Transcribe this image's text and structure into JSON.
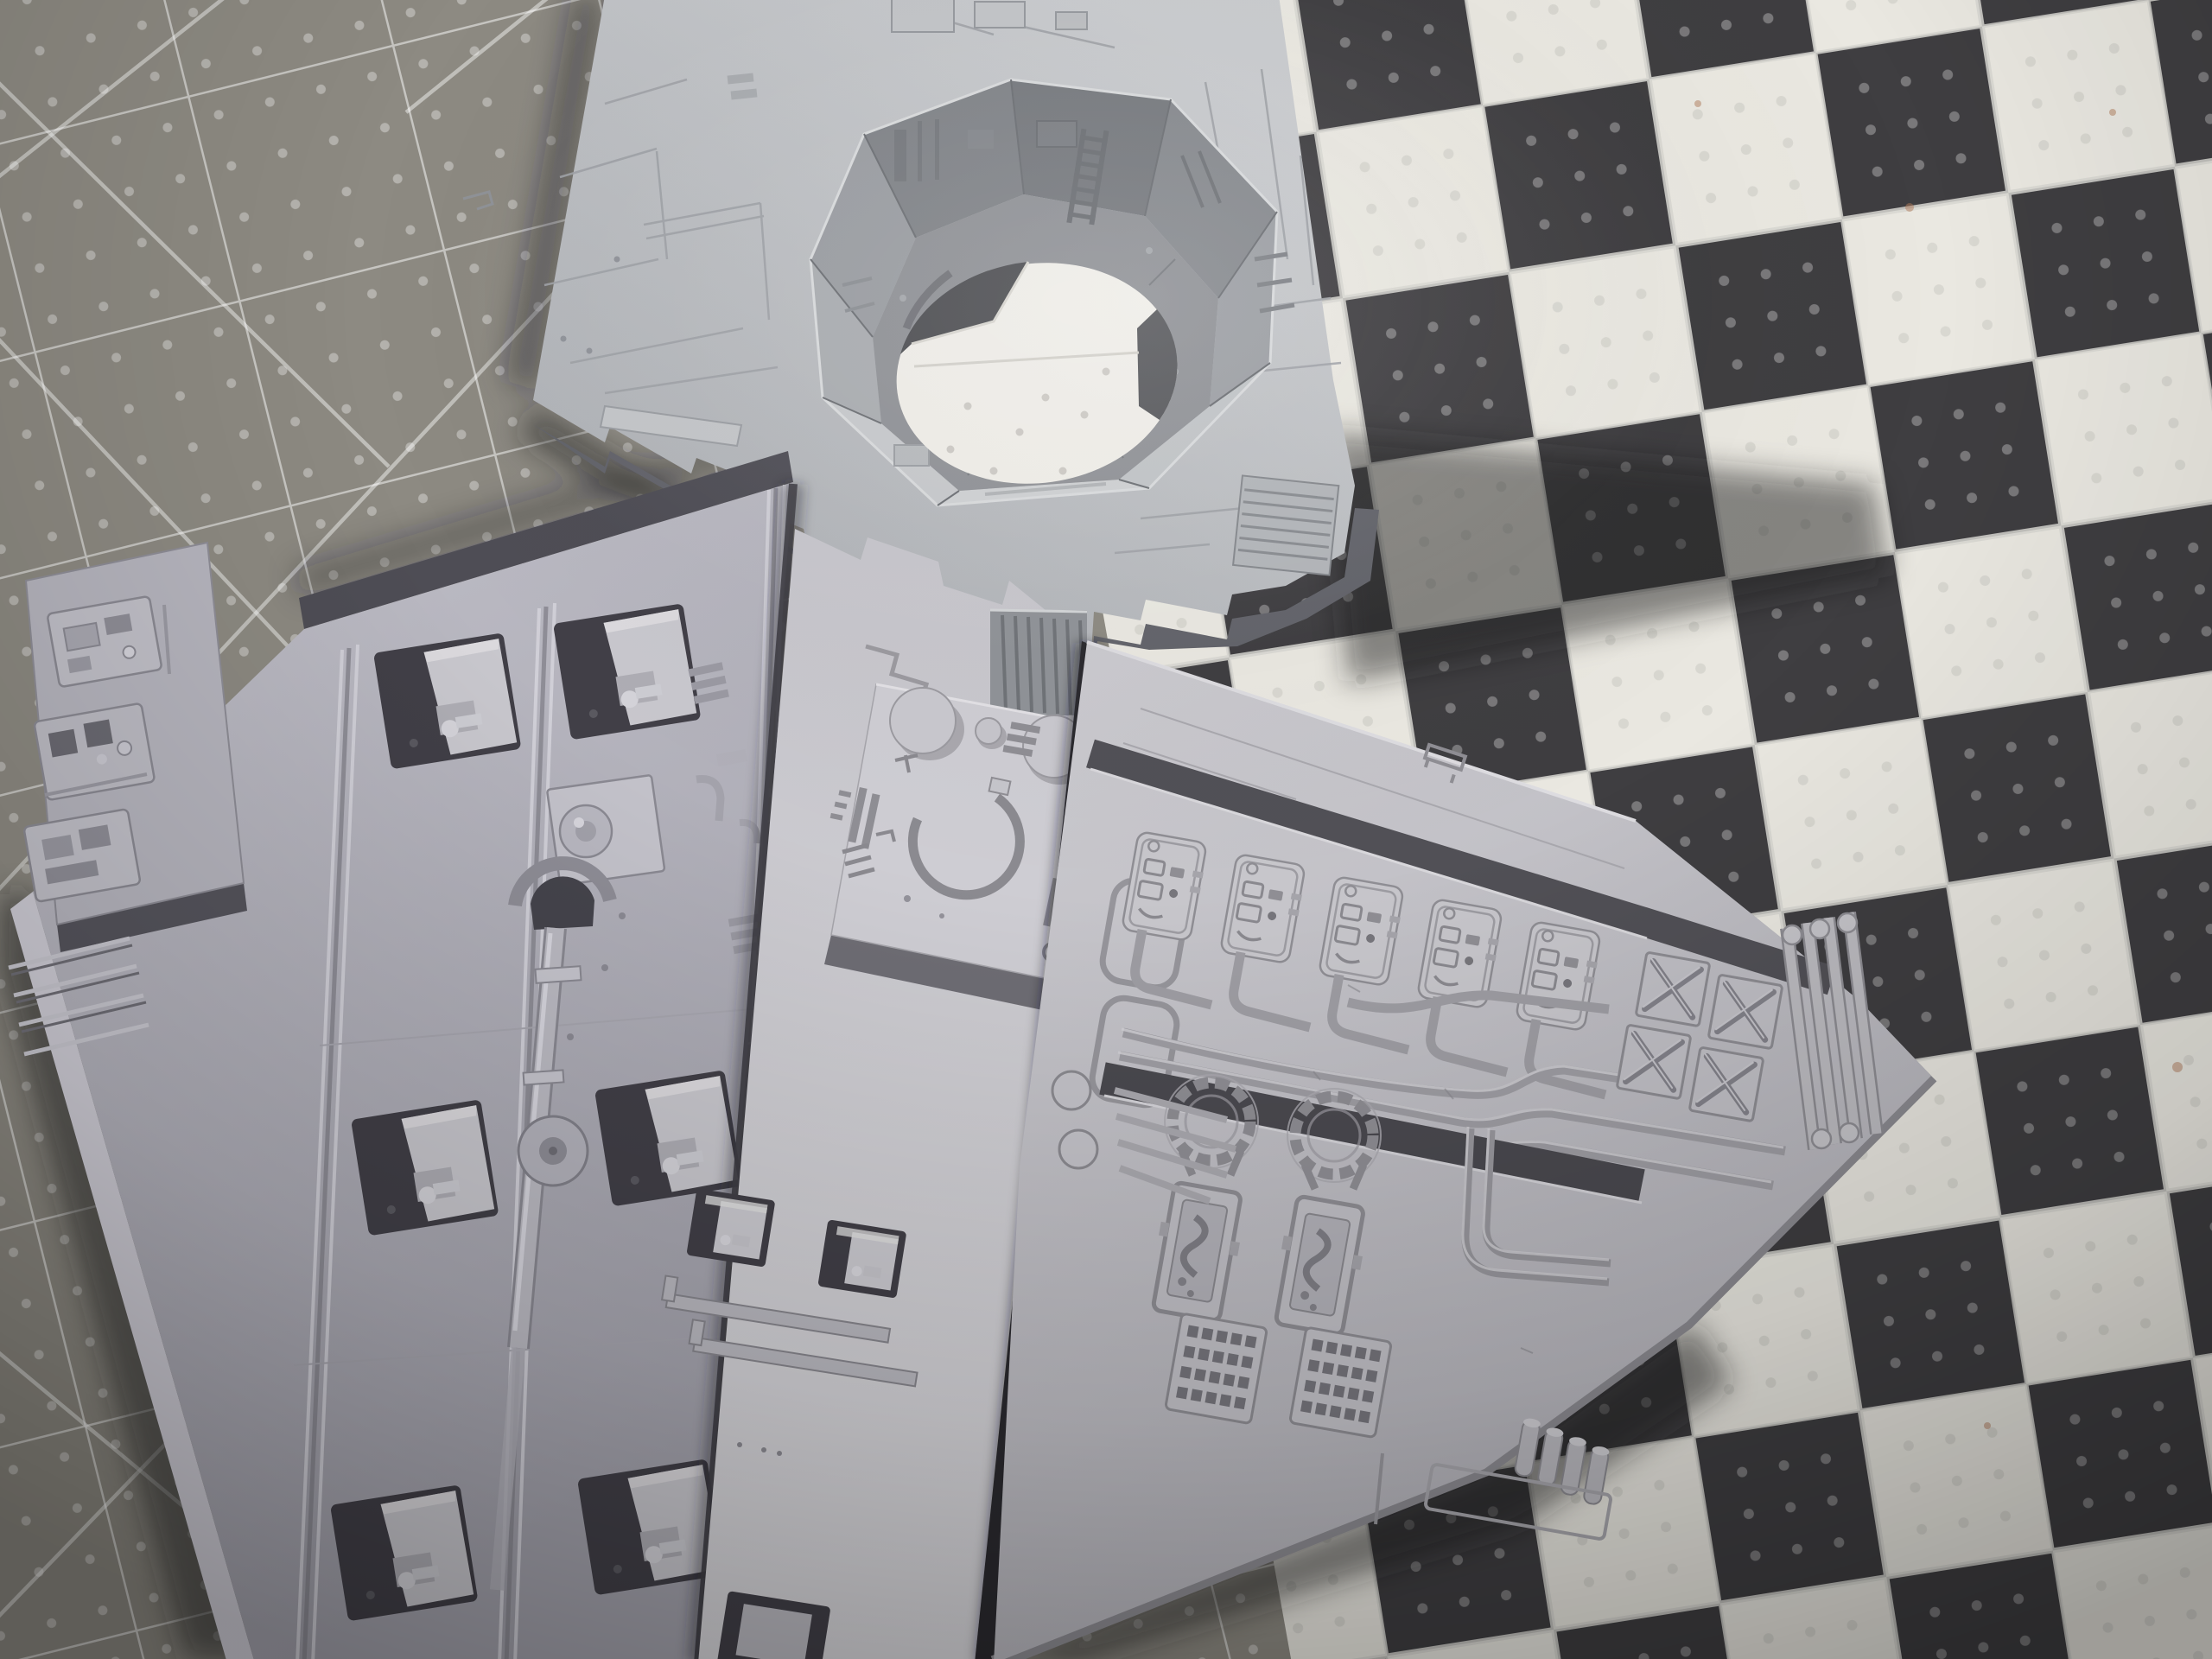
{
  "meta": {
    "title": "Grey sci-fi model kit panels on cutting mats",
    "description": "Photograph of four unpainted light-grey plastic model panels: a large plate with an octagonal recessed pit and circular cut-out, and three detailed greebled deck plates, lying on a grey grid cutting mat (left) and a black-and-white checkerboard mat (right)."
  },
  "palette": {
    "mat_base": "#8d8a82",
    "mat_line": "#ffffff",
    "checker_dark": "#3f3e41",
    "checker_light": "#eae8e1",
    "top_panel_light": "#c9cbce",
    "top_panel_dark": "#a7aaaf",
    "side_face": "#62636a",
    "lavender_light": "#c0bfc8",
    "lavender_dark": "#a3a2ac",
    "lavender_edge": "#4e4d55",
    "center_light": "#c6c5cb",
    "center_dark": "#d6d5d9",
    "right_light": "#cbcacf",
    "right_dark": "#b1b0b7",
    "recess_dark": "#413f47",
    "hole_white": "#efede8",
    "pit_floor": "#8e9095",
    "step_shadow": "#4a494f",
    "shadow": "#1f1f24",
    "rust": "#b07a5a"
  },
  "scene": {
    "objects": [
      {
        "id": "left-cutting-mat",
        "label": "grey grid cutting mat with embossed dots and diagonal guides"
      },
      {
        "id": "checkerboard-mat",
        "label": "black and white checkered mat with embossed dots"
      },
      {
        "id": "pit-panel",
        "label": "panel with octagonal recessed pit, wall ladder and round cut-out"
      },
      {
        "id": "hatch-pipe-panel",
        "label": "lavender-grey panel with rectangular hatches and piping"
      },
      {
        "id": "knob-ring-panel",
        "label": "bright panel with twin knobs, C-ring plate and two hatches"
      },
      {
        "id": "circuit-panel",
        "label": "panel with connector row, conduit runs, X-braced tiles, coil fittings and dot vents"
      }
    ]
  }
}
